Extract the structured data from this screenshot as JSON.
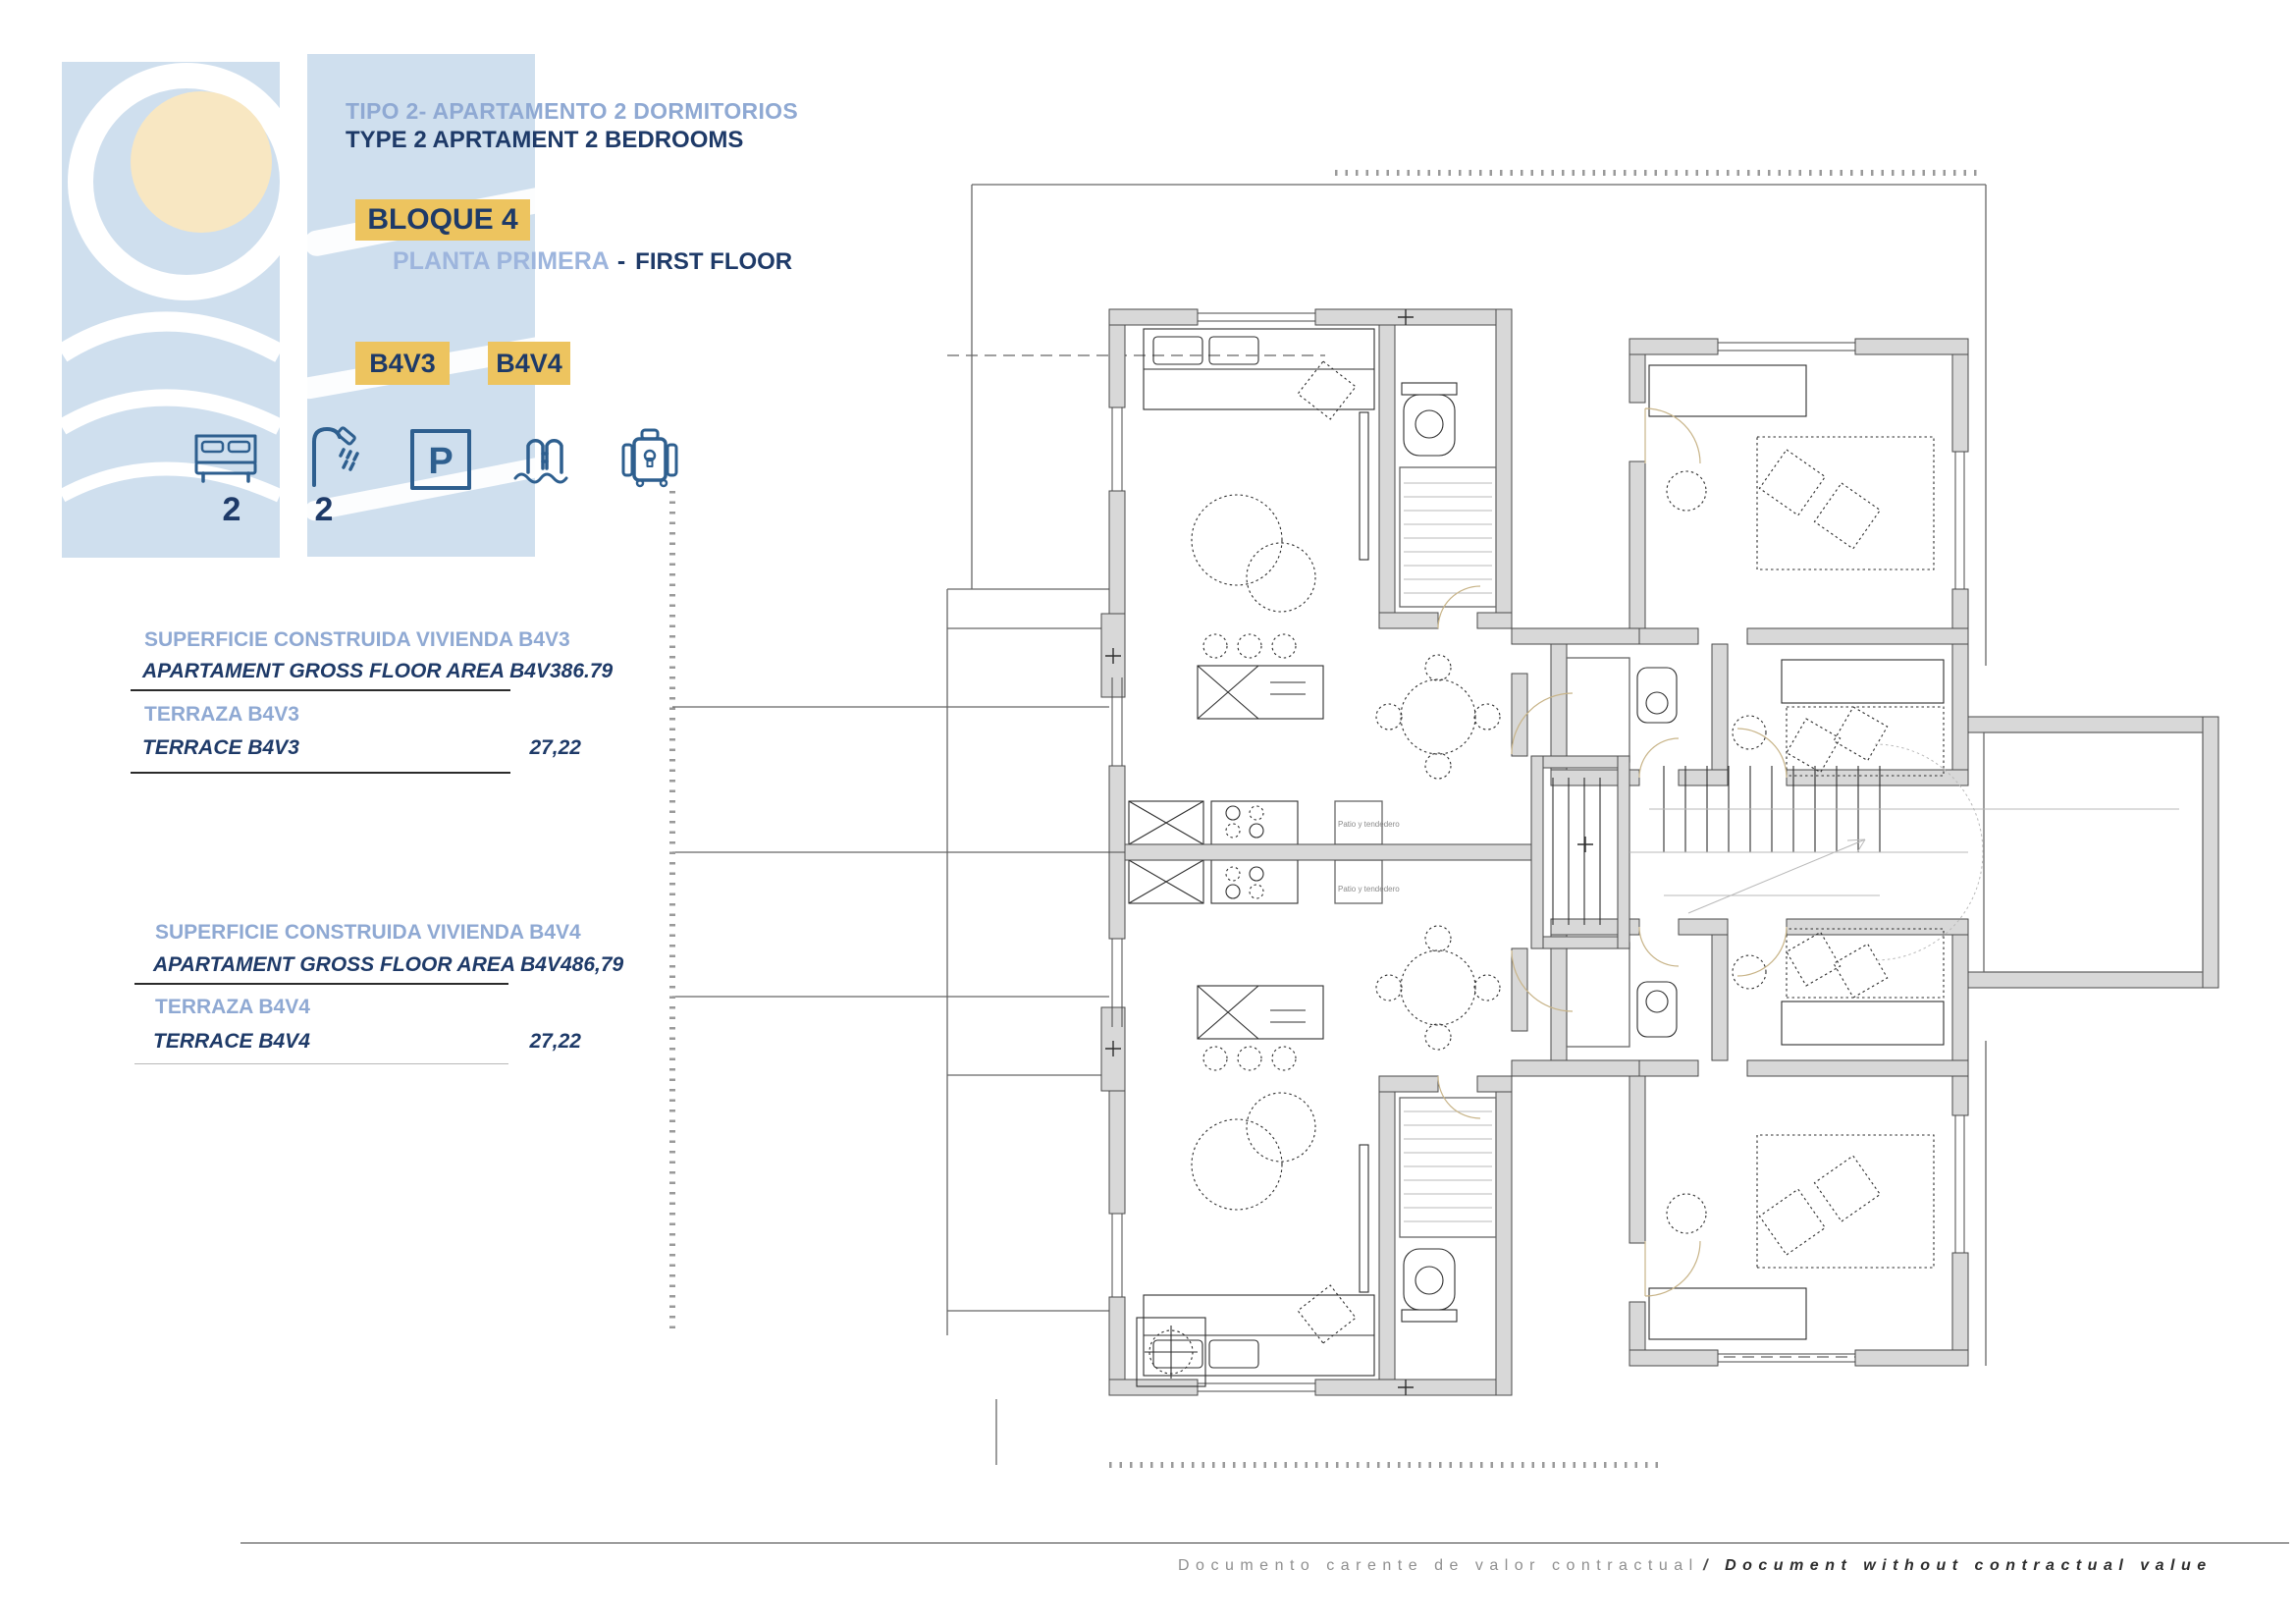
{
  "header": {
    "title_es": "TIPO 2- APARTAMENTO 2 DORMITORIOS",
    "title_en": "TYPE 2 APRTAMENT 2 BEDROOMS",
    "block_badge": "BLOQUE 4",
    "floor_es": "PLANTA PRIMERA",
    "floor_separator": "-",
    "floor_en": "FIRST FLOOR",
    "unit_badges": [
      "B4V3",
      "B4V4"
    ]
  },
  "amenities": {
    "bedrooms_count": "2",
    "bathrooms_count": "2",
    "parking_letter": "P",
    "icons": [
      "bed-icon",
      "shower-icon",
      "parking-icon",
      "pool-icon",
      "storage-icon"
    ]
  },
  "tables": [
    {
      "rows": [
        {
          "label_es": "SUPERFICIE CONSTRUIDA VIVIENDA B4V3",
          "label_en": "APARTAMENT GROSS FLOOR AREA B4V3",
          "value": "86.79"
        },
        {
          "label_es": "TERRAZA B4V3",
          "label_en": "TERRACE B4V3",
          "value": "27,22"
        }
      ]
    },
    {
      "rows": [
        {
          "label_es": "SUPERFICIE CONSTRUIDA VIVIENDA B4V4",
          "label_en": "APARTAMENT GROSS FLOOR AREA B4V4",
          "value": "86,79"
        },
        {
          "label_es": "TERRAZA B4V4",
          "label_en": "TERRACE B4V4",
          "value": "27,22"
        }
      ]
    }
  ],
  "floor_plan": {
    "patio_labels": [
      "Patio y tendedero",
      "Patio y tendedero"
    ]
  },
  "footer": {
    "text_es": "Documento carente de valor contractual",
    "separator": "/",
    "text_en": "Document without contractual value"
  },
  "colors": {
    "accent_gold": "#edc45f",
    "navy": "#1e3a68",
    "light_blue_text": "#8fa9d3",
    "deco_blue": "#cfdfee",
    "sun_yellow": "#f8e7c2",
    "icon_blue": "#2e5f8f",
    "wall_gray": "#d8d8d8"
  }
}
